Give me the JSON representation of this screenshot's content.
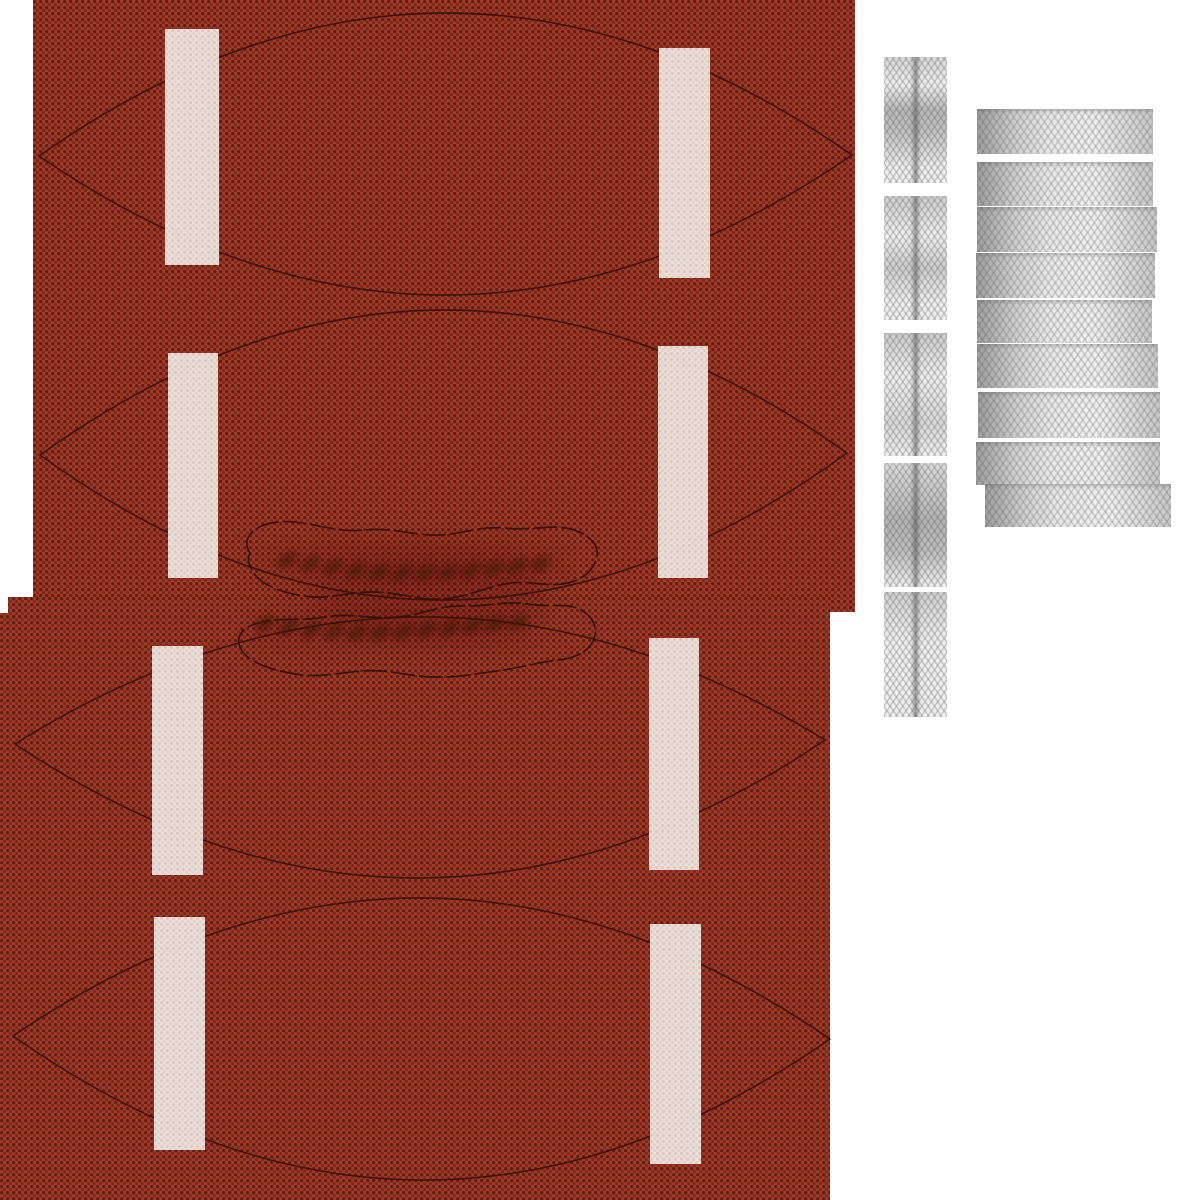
{
  "meta": {
    "description": "Texture atlas / UV skin for an American football: four pebbled red-brown leather panels with painted white stripes, seam outlines and lace-hole rows, plus grayscale woven lace fabric swatches on a white background",
    "visible_text": "none"
  },
  "canvas": {
    "width": 1200,
    "height": 1200,
    "background_color": "#ffffff"
  },
  "colors": {
    "background_white": "#ffffff",
    "leather_base": "#a23b2a",
    "leather_pebble_dark": "#5f1d12",
    "leather_pebble_mid": "#7c2718",
    "seam_line": "#2e1109",
    "stripe_white": "#f2e9e5",
    "stripe_pebble": "#d6c2bb",
    "lace_hole_dark": "#38100a",
    "lace_fabric_light": "#efefef",
    "lace_fabric_shadow": "#8f8f8f",
    "lace_center_line": "#454545"
  },
  "leather_sheets": [
    {
      "name": "leather-sheet-upper",
      "x": 33,
      "y": 0,
      "w": 822,
      "h": 612
    },
    {
      "name": "leather-sheet-lower",
      "x": 0,
      "y": 597,
      "w": 830,
      "h": 603,
      "notch": {
        "w": 8,
        "h": 16
      }
    }
  ],
  "panels": [
    {
      "name": "football-panel-1",
      "left_vertex": {
        "x": 39,
        "y": 156
      },
      "right_vertex": {
        "x": 852,
        "y": 155
      },
      "top_apex_y": 13,
      "bottom_apex_y": 295
    },
    {
      "name": "football-panel-2",
      "left_vertex": {
        "x": 40,
        "y": 455
      },
      "right_vertex": {
        "x": 847,
        "y": 453
      },
      "top_apex_y": 310,
      "bottom_apex_y": 600,
      "lace_slit": "bottom"
    },
    {
      "name": "football-panel-3",
      "left_vertex": {
        "x": 15,
        "y": 744
      },
      "right_vertex": {
        "x": 825,
        "y": 740
      },
      "top_apex_y": 617,
      "bottom_apex_y": 878,
      "lace_slit": "top"
    },
    {
      "name": "football-panel-4",
      "left_vertex": {
        "x": 13,
        "y": 1036
      },
      "right_vertex": {
        "x": 830,
        "y": 1039
      },
      "top_apex_y": 898,
      "bottom_apex_y": 1180
    }
  ],
  "stripes": [
    {
      "panel": 1,
      "side": "left",
      "x": 165,
      "y": 29,
      "w": 54,
      "h": 236
    },
    {
      "panel": 1,
      "side": "right",
      "x": 659,
      "y": 48,
      "w": 51,
      "h": 230
    },
    {
      "panel": 2,
      "side": "left",
      "x": 168,
      "y": 353,
      "w": 50,
      "h": 225
    },
    {
      "panel": 2,
      "side": "right",
      "x": 658,
      "y": 346,
      "w": 50,
      "h": 232
    },
    {
      "panel": 3,
      "side": "left",
      "x": 152,
      "y": 646,
      "w": 51,
      "h": 229
    },
    {
      "panel": 3,
      "side": "right",
      "x": 649,
      "y": 638,
      "w": 50,
      "h": 232
    },
    {
      "panel": 4,
      "side": "left",
      "x": 154,
      "y": 917,
      "w": 51,
      "h": 233
    },
    {
      "panel": 4,
      "side": "right",
      "x": 650,
      "y": 924,
      "w": 51,
      "h": 240
    }
  ],
  "lace_area": {
    "upper_outline_path": "M 250 553 C 242 541 250 529 267 524 C 299 515 329 534 364 530 C 394 527 414 536 439 535 C 464 534 479 526 504 528 C 534 531 551 524 571 529 C 589 534 599 545 597 556 C 595 568 585 579 568 583 C 545 588 529 579 505 584 C 480 589 465 598 440 599 C 415 600 399 592 372 592 C 345 592 329 600 305 596 C 282 593 261 585 253 572 C 248 564 247 558 250 553 Z",
    "lower_outline_path": "M 242 651 C 235 640 239 629 255 624 C 278 616 298 622 325 617 C 352 612 370 620 398 617 C 425 614 440 605 464 606 C 489 607 505 600 528 604 C 550 608 567 602 581 610 C 593 617 598 628 594 639 C 590 650 577 658 559 660 C 537 662 521 668 497 671 C 473 674 457 678 432 677 C 406 676 388 669 362 671 C 336 673 318 678 295 674 C 272 670 252 664 242 651 Z",
    "upper_holes": [
      [
        287,
        560
      ],
      [
        310,
        564
      ],
      [
        333,
        567
      ],
      [
        356,
        570
      ],
      [
        379,
        572
      ],
      [
        402,
        573
      ],
      [
        425,
        573
      ],
      [
        448,
        572
      ],
      [
        471,
        570
      ],
      [
        494,
        568
      ],
      [
        517,
        566
      ],
      [
        540,
        564
      ]
    ],
    "lower_holes": [
      [
        265,
        623
      ],
      [
        288,
        627
      ],
      [
        311,
        630
      ],
      [
        334,
        632
      ],
      [
        357,
        633
      ],
      [
        380,
        633
      ],
      [
        403,
        632
      ],
      [
        426,
        630
      ],
      [
        449,
        628
      ],
      [
        472,
        626
      ],
      [
        495,
        624
      ],
      [
        518,
        622
      ]
    ],
    "hole_rx": 11,
    "hole_ry": 6,
    "hole_rotation_deg": -33,
    "shading": [
      {
        "cx": 415,
        "cy": 563,
        "rx": 155,
        "ry": 26
      },
      {
        "cx": 395,
        "cy": 629,
        "rx": 150,
        "ry": 24
      },
      {
        "cx": 430,
        "cy": 598,
        "rx": 120,
        "ry": 40
      }
    ]
  },
  "lace_texture_swatches": {
    "vertical_strips": [
      {
        "x": 884,
        "y": 57,
        "w": 63,
        "h": 126
      },
      {
        "x": 884,
        "y": 196,
        "w": 63,
        "h": 124
      },
      {
        "x": 884,
        "y": 333,
        "w": 63,
        "h": 123
      },
      {
        "x": 884,
        "y": 463,
        "w": 63,
        "h": 124
      },
      {
        "x": 884,
        "y": 592,
        "w": 63,
        "h": 125
      }
    ],
    "horizontal_strips": [
      {
        "x": 977,
        "y": 109,
        "w": 176,
        "h": 45
      },
      {
        "x": 977,
        "y": 162,
        "w": 176,
        "h": 44
      },
      {
        "x": 977,
        "y": 207,
        "w": 180,
        "h": 45
      },
      {
        "x": 976,
        "y": 253,
        "w": 179,
        "h": 45
      },
      {
        "x": 977,
        "y": 300,
        "w": 175,
        "h": 43
      },
      {
        "x": 977,
        "y": 344,
        "w": 181,
        "h": 44
      },
      {
        "x": 978,
        "y": 392,
        "w": 182,
        "h": 46
      },
      {
        "x": 976,
        "y": 442,
        "w": 184,
        "h": 43
      },
      {
        "x": 985,
        "y": 484,
        "w": 186,
        "h": 43
      }
    ]
  }
}
